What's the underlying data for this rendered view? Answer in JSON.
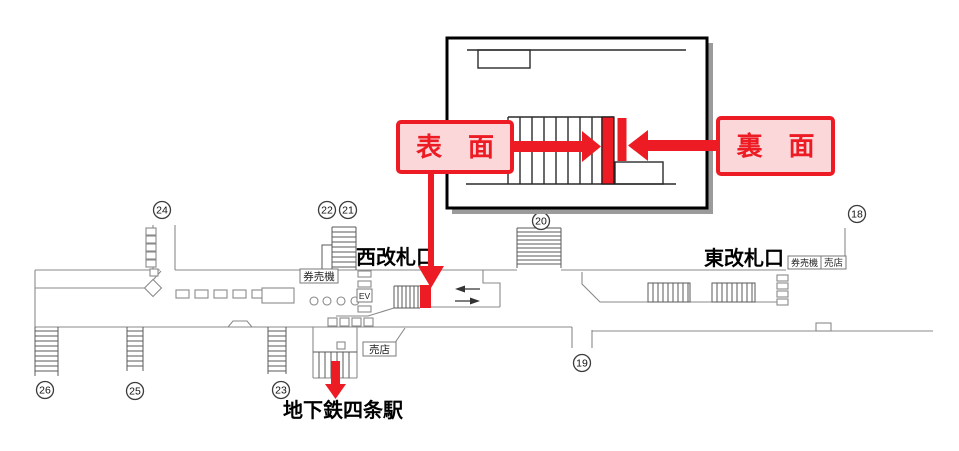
{
  "colors": {
    "accent_red": "#ed1c24",
    "label_pink": "#fcd7da",
    "map_line_gray": "#8a8a8a",
    "structure_gray": "#5a5a5a"
  },
  "detail_inset": {
    "front_label": "表　面",
    "back_label": "裏　面"
  },
  "station_map": {
    "west_gate_label": "西改札口",
    "east_gate_label": "東改札口",
    "subway_station_label": "地下鉄四条駅",
    "ticket_machine_west_label": "券売機",
    "ticket_machine_east_label": "券売機",
    "kiosk_east_label": "売店",
    "kiosk_center_label": "売店",
    "elevator_label": "EV",
    "exit_numbers": [
      "18",
      "19",
      "20",
      "21",
      "22",
      "23",
      "24",
      "25",
      "26"
    ]
  }
}
